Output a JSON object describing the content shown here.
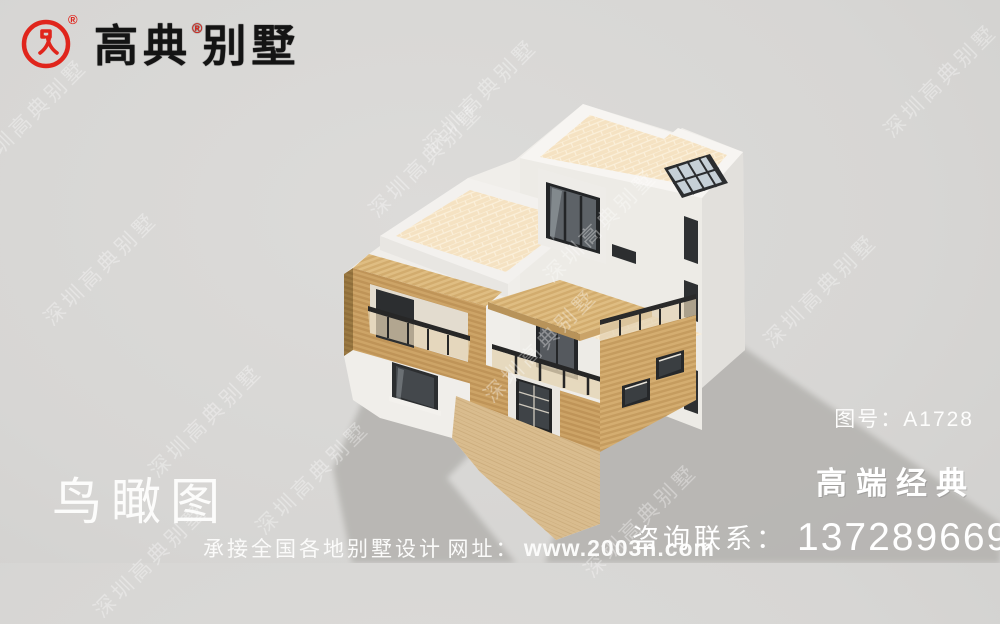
{
  "logo": {
    "brand_left": "高典",
    "brand_right": "别墅",
    "registered": "®",
    "emblem": "red-seal-circle-icon"
  },
  "watermark": {
    "text": "深圳高典别墅"
  },
  "stage": {
    "view_label": "鸟瞰图",
    "drawing_label": "图号：A1728",
    "tagline": "高端经典"
  },
  "footer": {
    "service": "承接全国各地别墅设计",
    "website_label": "网址：",
    "url": "www.2003n.com",
    "contact_label": "咨询联系：",
    "phone": "13728966966"
  },
  "scene": {
    "subject": "modern-villa-birdseye-render",
    "materials": [
      "white-plaster",
      "wood-cladding",
      "cream-roof-tile",
      "dark-window-frames"
    ],
    "skylight": "glass-grid-skylight"
  },
  "colors": {
    "accent_red": "#e0251c",
    "background": "#d7d6d4",
    "shadow": "#b6b4b1",
    "white_wall": "#f0eeea",
    "wood": "#c49b5e",
    "wood_dark": "#9b7a43",
    "roof_tile": "#f5e2c2",
    "deck": "#d9bc8e",
    "glass_dark": "#44484c",
    "railing_glass": "#e6d6b6"
  }
}
